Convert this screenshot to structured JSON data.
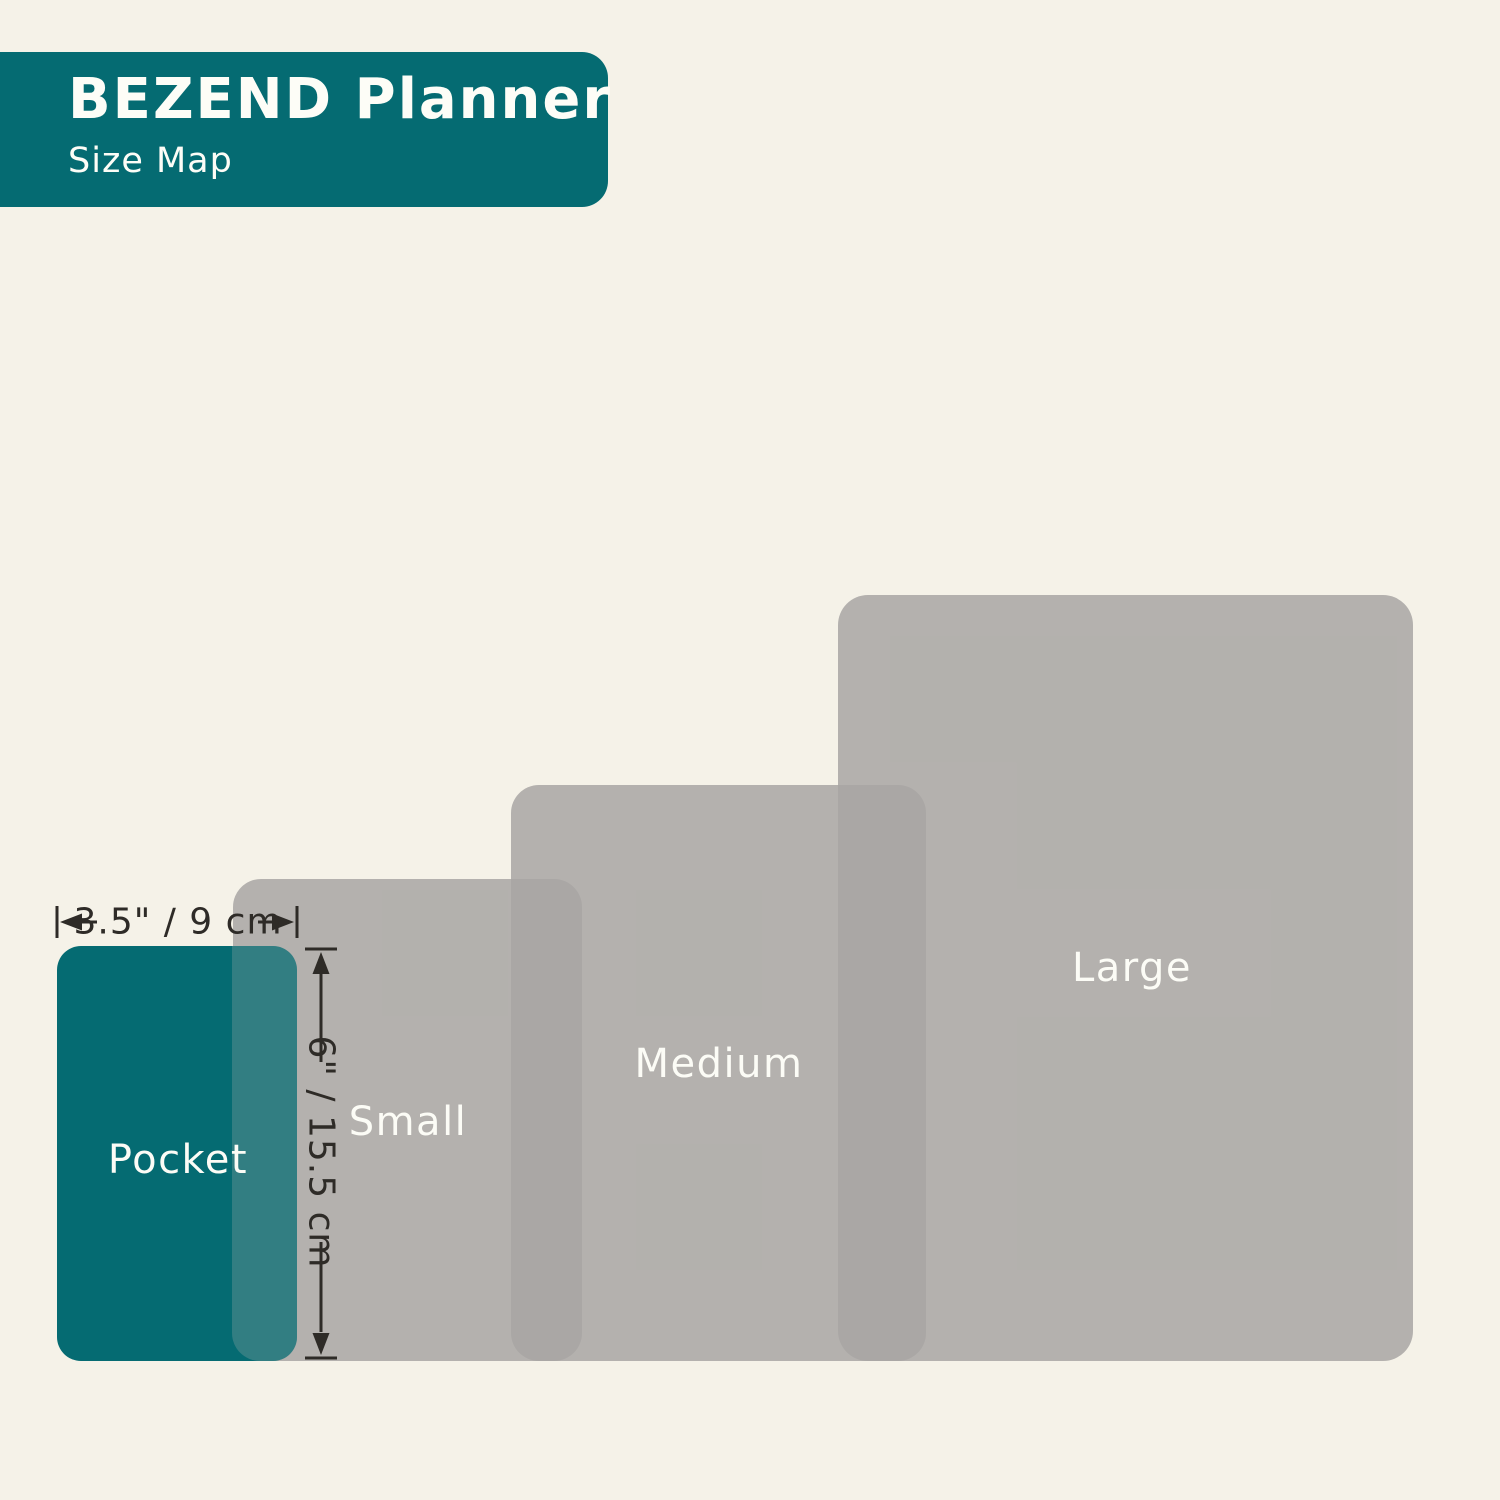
{
  "header": {
    "title": "BEZEND Planner",
    "subtitle": "Size Map"
  },
  "dimensions": {
    "width_label": "3.5\" / 9 cm",
    "height_label": "6\" / 15.5 cm"
  },
  "sizes": [
    {
      "name": "Pocket",
      "width_in": "3.5",
      "height_in": "6",
      "width_cm": "9",
      "height_cm": "15.5"
    },
    {
      "name": "Small"
    },
    {
      "name": "Medium"
    },
    {
      "name": "Large"
    }
  ],
  "colors": {
    "background": "#F5F2E8",
    "teal": "#056B72",
    "gray_rect": "#B4B2AE",
    "gray_overlap": "#AAA8A4",
    "teal_overlap": "#2F7C80",
    "annotation_text": "#2E2B27",
    "label_text": "#FCFCF6"
  }
}
